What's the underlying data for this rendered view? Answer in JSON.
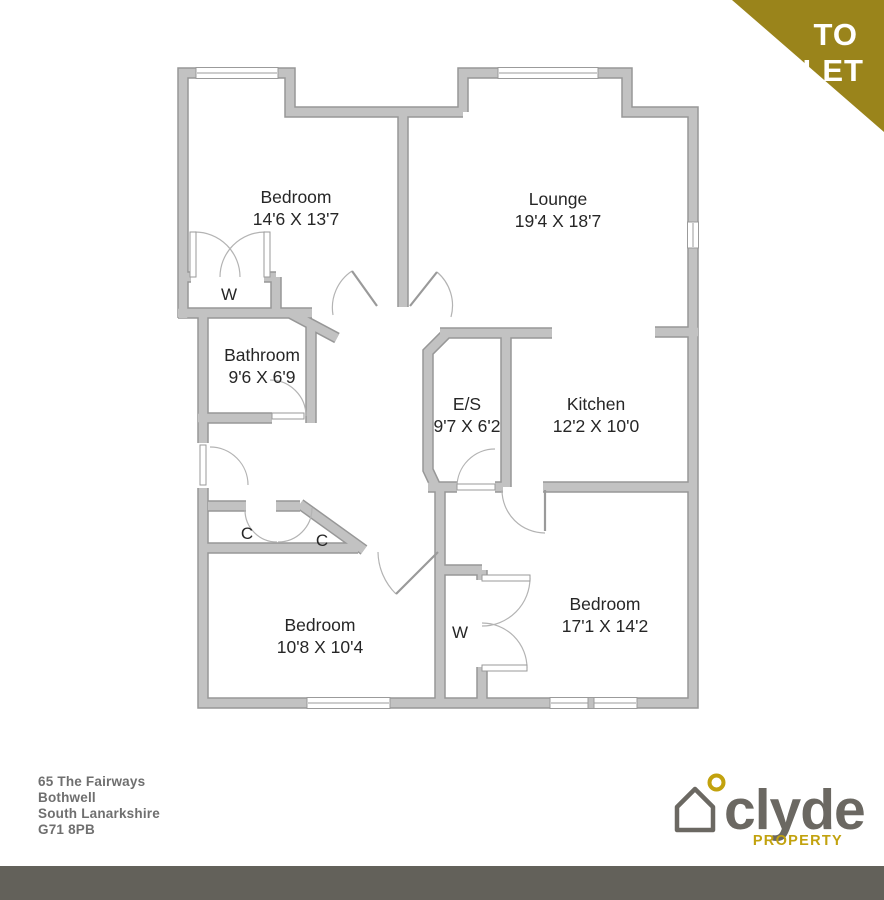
{
  "banner": {
    "line1": "TO",
    "line2": "LET",
    "color": "#9a841b"
  },
  "floorplan": {
    "wall_color": "#c2c2c2",
    "wall_outline": "#979797",
    "rooms": [
      {
        "name": "Bedroom",
        "dims": "14'6 X 13'7"
      },
      {
        "name": "Lounge",
        "dims": "19'4 X 18'7"
      },
      {
        "name": "Bathroom",
        "dims": "9'6 X 6'9"
      },
      {
        "name": "E/S",
        "dims": "9'7 X 6'2"
      },
      {
        "name": "Kitchen",
        "dims": "12'2 X 10'0"
      },
      {
        "name": "Bedroom",
        "dims": "10'8 X 10'4"
      },
      {
        "name": "Bedroom",
        "dims": "17'1 X 14'2"
      }
    ],
    "closets": {
      "wardrobe_top": "W",
      "cupboard_left": "C",
      "cupboard_right": "C",
      "wardrobe_bottom": "W"
    }
  },
  "address": {
    "color": "#6f6f6f",
    "lines": [
      "65 The Fairways",
      "Bothwell",
      "South Lanarkshire",
      "G71 8PB"
    ]
  },
  "logo": {
    "brand": "clyde",
    "tagline": "PROPERTY",
    "brand_color": "#6b6862",
    "accent_color": "#c2a20e"
  },
  "footer": {
    "color": "#63615a"
  }
}
